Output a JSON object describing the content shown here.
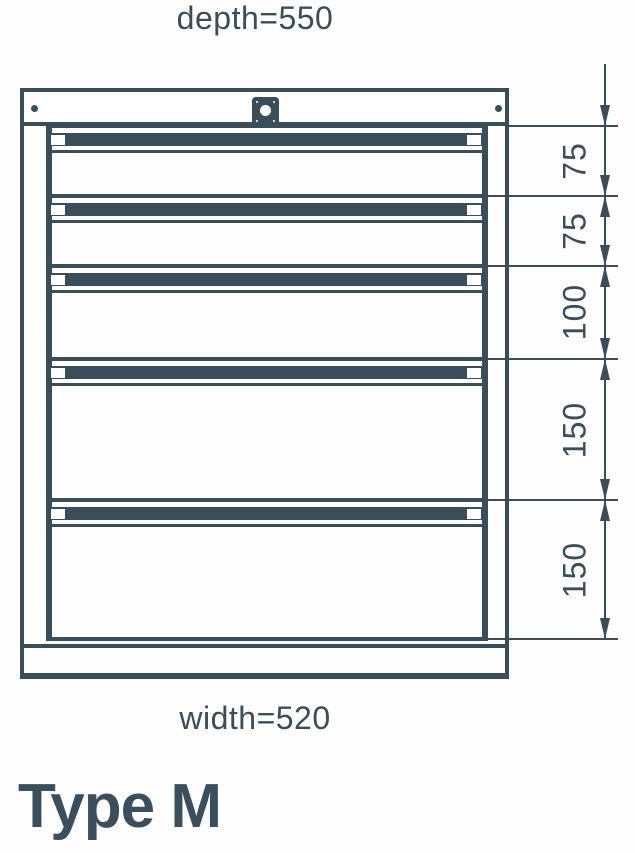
{
  "page": {
    "title": "Type M"
  },
  "drawing": {
    "depth_label": "depth=550",
    "width_label": "width=520",
    "drawer_heights": [
      "75",
      "75",
      "100",
      "150",
      "150"
    ],
    "depth_mm": 550,
    "width_mm": 520
  },
  "colors": {
    "ink": "#3a4d5b",
    "background": "#ffffff"
  }
}
